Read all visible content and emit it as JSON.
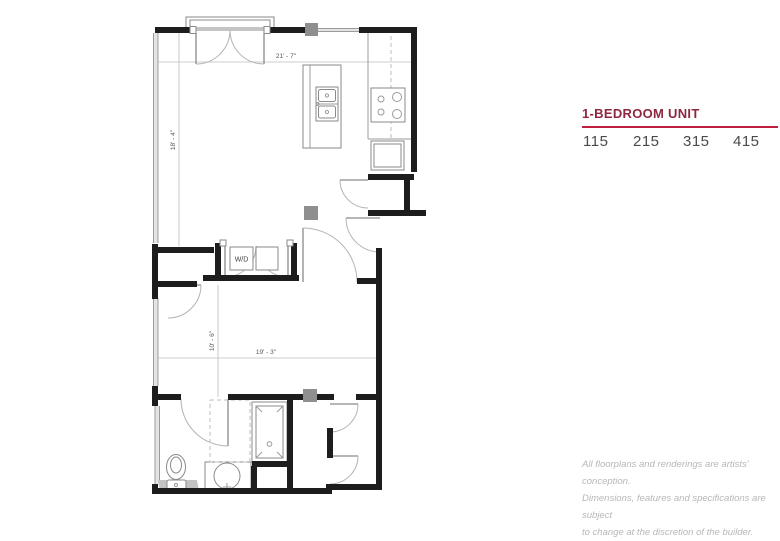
{
  "panel": {
    "title": "1-BEDROOM UNIT",
    "units": [
      "115",
      "215",
      "315",
      "415"
    ],
    "disclaimer_lines": [
      "All floorplans and renderings are artists' conception.",
      "Dimensions, features and specifications are subject",
      "to change at the discretion of the builder."
    ],
    "colors": {
      "title_red": "#8e2640",
      "rule_red": "#bf1e3f",
      "unit_text": "#4a4a4c",
      "disclaimer_gray": "#b5b7ba"
    }
  },
  "floorplan": {
    "dimensions": {
      "living_width": "21' - 7\"",
      "living_height": "18' - 4\"",
      "bedroom_width": "19' - 3\"",
      "bedroom_height": "10' - 6\""
    },
    "labels": {
      "washer_dryer": "W/D"
    },
    "colors": {
      "wall": "#1d1d1d",
      "thin_line": "#9b9b9b",
      "column_gray": "#8f8f8f",
      "dim_text": "#555555"
    }
  }
}
